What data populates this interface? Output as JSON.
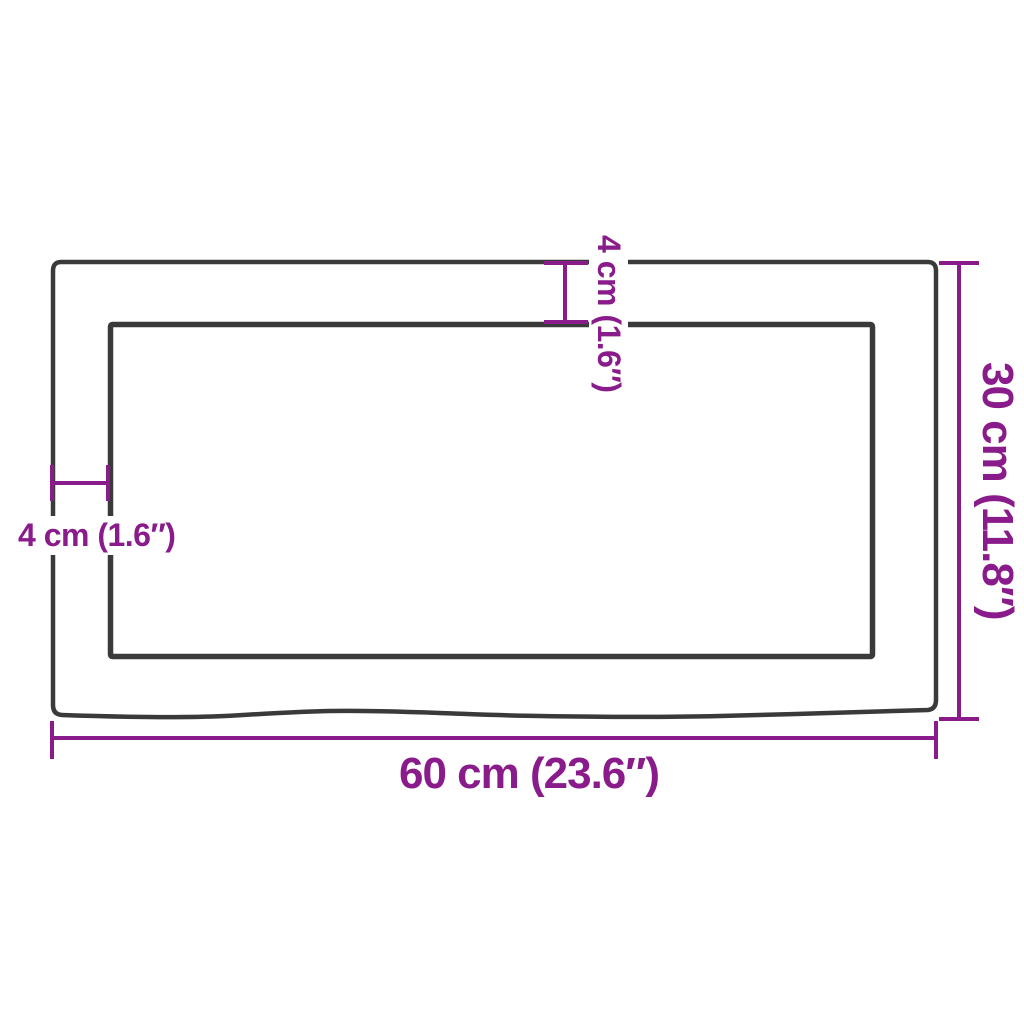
{
  "colors": {
    "dimension": "#8A1B8B",
    "outline": "#3A3A3A",
    "background": "#FFFFFF"
  },
  "labels": {
    "top_inset": "4 cm (1.6″)",
    "left_inset": "4 cm (1.6″)",
    "height": "30 cm (11.8″)",
    "width": "60 cm (23.6″)"
  }
}
